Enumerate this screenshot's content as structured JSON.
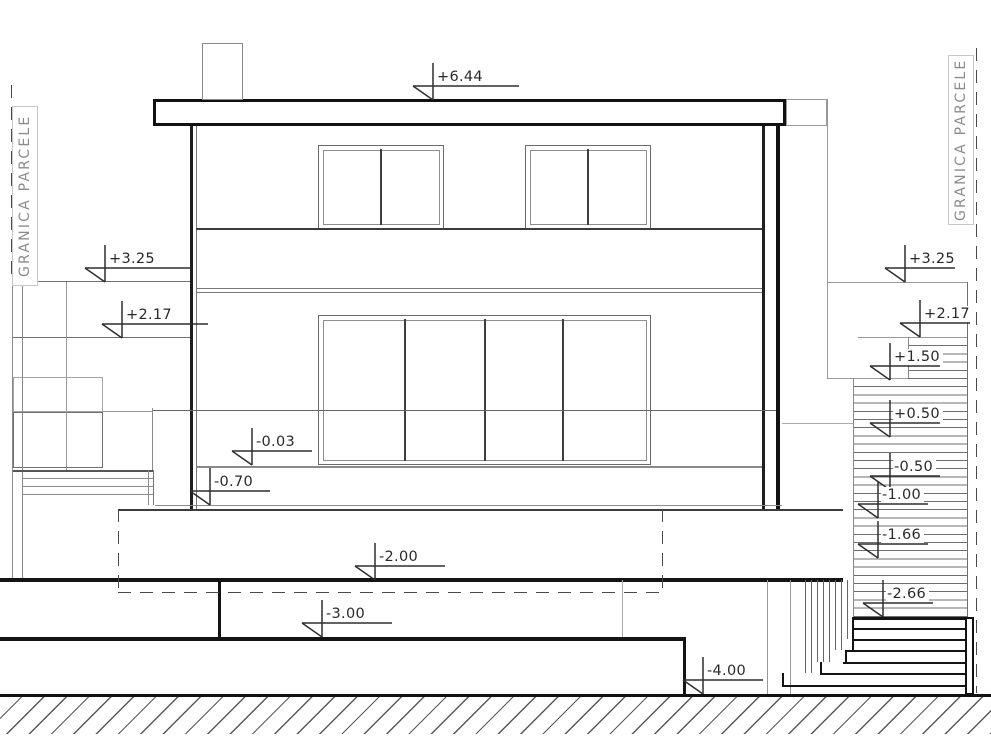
{
  "boundary": {
    "left_label": "GRANICA PARCELE",
    "right_label": "GRANICA PARCELE"
  },
  "elevation_markers": [
    {
      "label": "+6.44"
    },
    {
      "label": "+3.25"
    },
    {
      "label": "+2.17"
    },
    {
      "label": "-0.03"
    },
    {
      "label": "-0.70"
    },
    {
      "label": "-2.00"
    },
    {
      "label": "-3.00"
    },
    {
      "label": "-4.00"
    },
    {
      "label": "+3.25"
    },
    {
      "label": "+2.17"
    },
    {
      "label": "+1.50"
    },
    {
      "label": "+0.50"
    },
    {
      "label": "-0.50"
    },
    {
      "label": "-1.00"
    },
    {
      "label": "-1.66"
    },
    {
      "label": "-2.66"
    }
  ],
  "colors": {
    "line": "#141414",
    "light_line": "#8a8a8a",
    "marker_text": "#2a2a2a",
    "boundary_text": "#8c8c8c",
    "background": "#ffffff"
  }
}
